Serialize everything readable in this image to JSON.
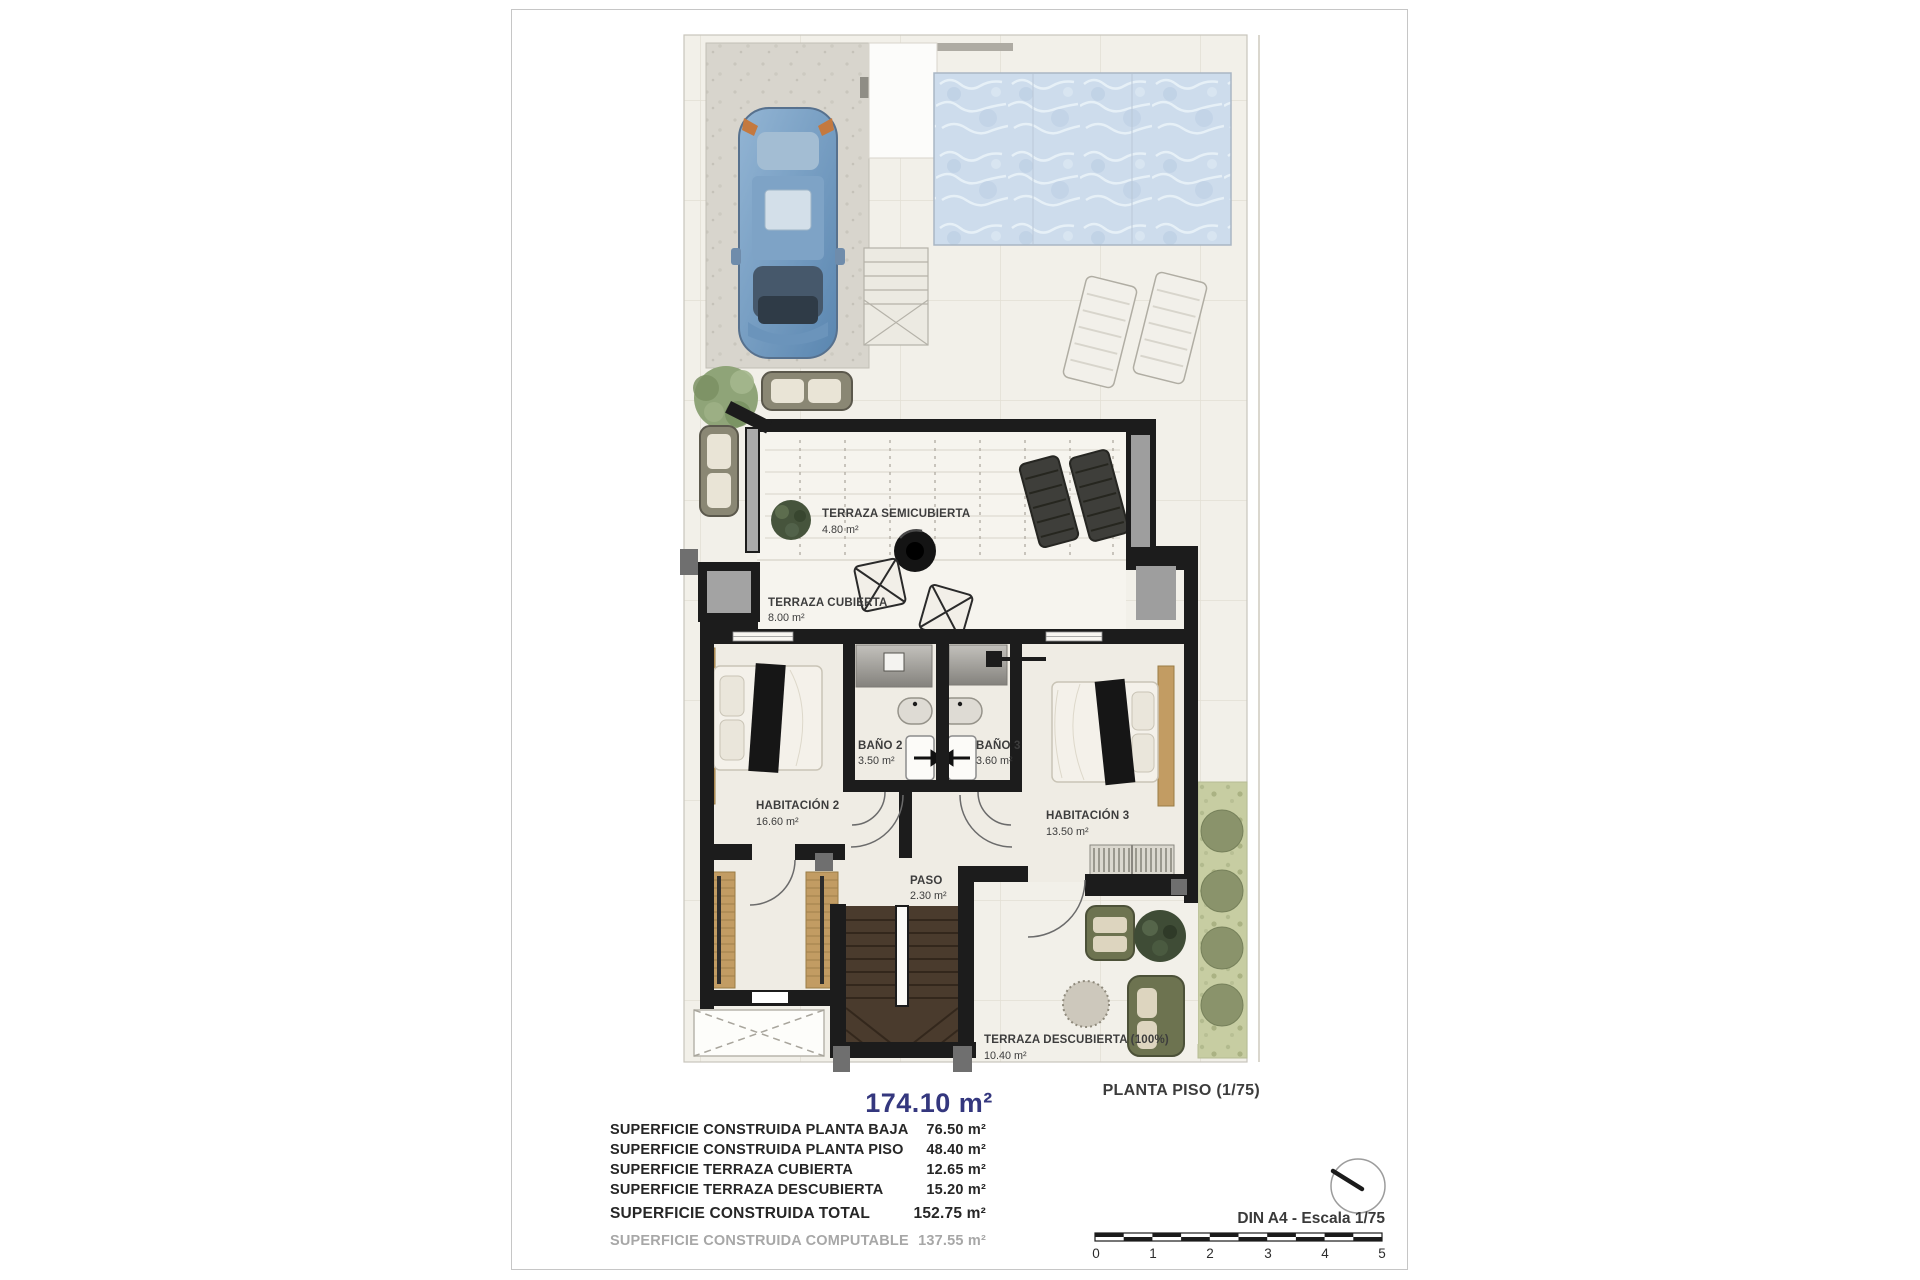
{
  "plan": {
    "title": "PLANTA PISO (1/75)",
    "total_area_label": "174.10 m²",
    "rooms": [
      {
        "name": "TERRAZA SEMICUBIERTA",
        "area": "4.80 m²"
      },
      {
        "name": "TERRAZA CUBIERTA",
        "area": "8.00 m²"
      },
      {
        "name": "BAÑO 2",
        "area": "3.50 m²"
      },
      {
        "name": "BAÑO 3",
        "area": "3.60 m²"
      },
      {
        "name": "HABITACIÓN 2",
        "area": "16.60 m²"
      },
      {
        "name": "HABITACIÓN 3",
        "area": "13.50 m²"
      },
      {
        "name": "PASO",
        "area": "2.30 m²"
      },
      {
        "name": "TERRAZA DESCUBIERTA (100%)",
        "area": "10.40 m²"
      }
    ]
  },
  "surfaces": {
    "rows": [
      {
        "label": "SUPERFICIE CONSTRUIDA PLANTA BAJA",
        "value": "76.50 m²"
      },
      {
        "label": "SUPERFICIE CONSTRUIDA PLANTA PISO",
        "value": "48.40 m²"
      },
      {
        "label": "SUPERFICIE TERRAZA CUBIERTA",
        "value": "12.65 m²"
      },
      {
        "label": "SUPERFICIE TERRAZA DESCUBIERTA",
        "value": "15.20 m²"
      }
    ],
    "total": {
      "label": "SUPERFICIE CONSTRUIDA TOTAL",
      "value": "152.75 m²"
    },
    "computable": {
      "label": "SUPERFICIE CONSTRUIDA COMPUTABLE",
      "value": "137.55 m²"
    }
  },
  "scale": {
    "note": "DIN A4 - Escala 1/75",
    "ticks": [
      "0",
      "1",
      "2",
      "3",
      "4",
      "5"
    ]
  },
  "colors": {
    "accent_blue": "#34377e",
    "wall_black": "#1c1c1c",
    "pool_blue": "#cddcec",
    "olive_furniture": "#6d7350",
    "wood": "#c29c63",
    "garden_green": "#c7cda2"
  }
}
